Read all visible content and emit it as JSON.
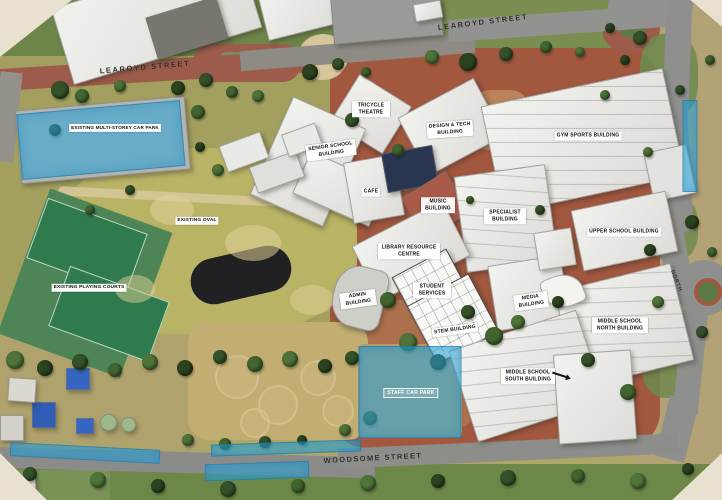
{
  "map": {
    "type": "aerial-site-plan",
    "streets": [
      {
        "id": "learoyd-street-west",
        "text": "LEAROYD STREET"
      },
      {
        "id": "learoyd-street-east",
        "text": "LEAROYD STREET"
      },
      {
        "id": "woodsome-street",
        "text": "WOODSOME STREET"
      },
      {
        "id": "north-road",
        "text": "NORTH"
      }
    ],
    "labels": [
      {
        "id": "existing-oval",
        "text": "EXISTING OVAL"
      },
      {
        "id": "existing-playing-courts",
        "text": "EXISTING PLAYING COURTS"
      },
      {
        "id": "tricycle-theatre",
        "text": "TRICYCLE THEATRE"
      },
      {
        "id": "senior-school-building",
        "text": "SENIOR SCHOOL BUILDING"
      },
      {
        "id": "design-tech-building",
        "text": "DESIGN & TECH BUILDING"
      },
      {
        "id": "gym-sports-building",
        "text": "GYM SPORTS BUILDING"
      },
      {
        "id": "cafe",
        "text": "CAFE"
      },
      {
        "id": "music-building",
        "text": "MUSIC BUILDING"
      },
      {
        "id": "specialist-building",
        "text": "SPECIALIST BUILDING"
      },
      {
        "id": "upper-school-building",
        "text": "UPPER SCHOOL BUILDING"
      },
      {
        "id": "library-resource-centre",
        "text": "LIBRARY RESOURCE CENTRE"
      },
      {
        "id": "admin-building",
        "text": "ADMIN BUILDING"
      },
      {
        "id": "student-services",
        "text": "STUDENT SERVICES"
      },
      {
        "id": "stem-building",
        "text": "STEM BUILDING"
      },
      {
        "id": "media-building",
        "text": "MEDIA BUILDING"
      },
      {
        "id": "middle-school-north-building",
        "text": "MIDDLE SCHOOL NORTH BUILDING"
      },
      {
        "id": "middle-school-south-building",
        "text": "MIDDLE SCHOOL SOUTH BUILDING"
      }
    ],
    "overlays": [
      {
        "id": "existing-multi-storey-car-park",
        "label": "EXISTING MULTI-STOREY CAR PARK"
      },
      {
        "id": "staff-car-park",
        "label": "STAFF CAR PARK"
      },
      {
        "id": "kerbside-parking-east",
        "label": ""
      },
      {
        "id": "woodsome-parking-west",
        "label": ""
      },
      {
        "id": "woodsome-parking-middle",
        "label": ""
      },
      {
        "id": "woodsome-parking-south",
        "label": ""
      }
    ],
    "colors": {
      "highlight_blue": "#2aa6db",
      "background_beige": "#e8e1d0",
      "road_asphalt": "#8f8f8d",
      "road_red_asphalt": "#9c5b4b",
      "campus_brick": "#a2573f",
      "grass_oval": "#b7b163",
      "tennis_court_green": "#2f7b4d"
    }
  }
}
